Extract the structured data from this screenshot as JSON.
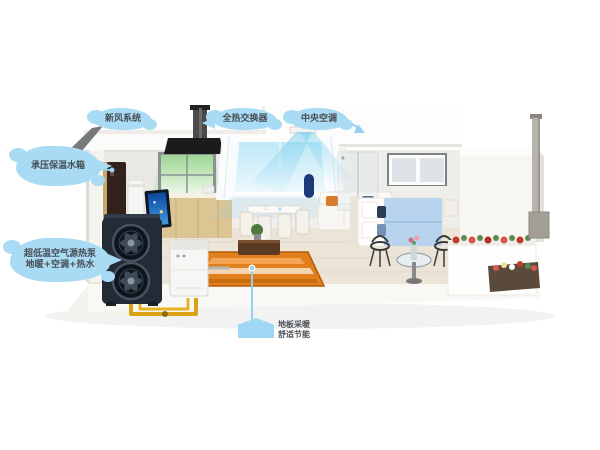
{
  "colors": {
    "background": "#ffffff",
    "callout_fill": "#a9dbf5",
    "callout_text": "#474d52",
    "leader_blue": "#8fd2f2",
    "airflow_blue": "#7fd0ef",
    "pipe_yellow": "#d9a414",
    "rug_orange": "#e07f1c",
    "heat_pump_body": "#222b36",
    "kitchen_glow_green": "#a5d89b",
    "window_glow_cyan": "#bfe9f8",
    "tv_screen_blue": "#1565c0",
    "bed_blanket_blue": "#b7d3ee"
  },
  "callouts": {
    "fresh_air": {
      "label": "新风系统"
    },
    "heat_recovery_unit": {
      "label": "全热交换器"
    },
    "central_ac": {
      "label": "中央空调"
    },
    "hot_water_tank": {
      "label": "承压保温水箱"
    },
    "heat_pump_unit": {
      "line1": "超低温空气源热泵",
      "line2": "地暖+空调+热水"
    },
    "floor_heating": {
      "line1": "地板采暖",
      "line2": "舒适节能"
    }
  },
  "icons": {
    "callout_cloud": "fluffy-cloud-bubble",
    "floor_heating_tag": "roof-pentagon-tag",
    "leader_dot": "filled-circle",
    "fan": "axial-fan-blades",
    "airflow": "cool-air-cone"
  }
}
